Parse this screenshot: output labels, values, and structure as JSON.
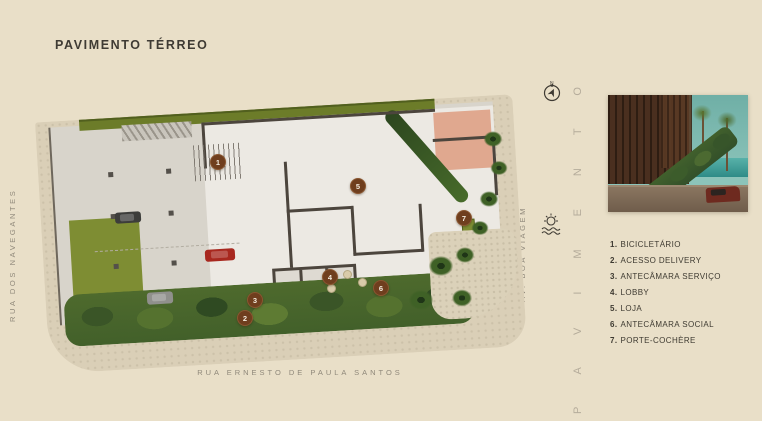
{
  "header": {
    "title": "PAVIMENTO TÉRREO"
  },
  "streets": {
    "left": "RUA DOS NAVEGANTES",
    "bottom": "RUA ERNESTO DE PAULA SANTOS",
    "right": "AV. BOA VIAGEM"
  },
  "watermark_text": "PAVIMENTO",
  "compass_label": "N",
  "legend": {
    "items": [
      {
        "num": "1.",
        "label": "BICICLETÁRIO"
      },
      {
        "num": "2.",
        "label": "ACESSO DELIVERY"
      },
      {
        "num": "3.",
        "label": "ANTECÂMARA SERVIÇO"
      },
      {
        "num": "4.",
        "label": "LOBBY"
      },
      {
        "num": "5.",
        "label": "LOJA"
      },
      {
        "num": "6.",
        "label": "ANTECÂMARA SOCIAL"
      },
      {
        "num": "7.",
        "label": "PORTE-COCHÈRE"
      }
    ]
  },
  "plan": {
    "markers": [
      {
        "num": "1",
        "x": 218,
        "y": 162
      },
      {
        "num": "5",
        "x": 358,
        "y": 186
      },
      {
        "num": "7",
        "x": 464,
        "y": 218
      },
      {
        "num": "4",
        "x": 330,
        "y": 277
      },
      {
        "num": "6",
        "x": 381,
        "y": 288
      },
      {
        "num": "3",
        "x": 255,
        "y": 300
      },
      {
        "num": "2",
        "x": 245,
        "y": 318
      }
    ]
  },
  "colors": {
    "background": "#E9DFC8",
    "marker": "#6F3E1E",
    "wall": "#4C453D",
    "lawn_green": "#7E8D33",
    "terrace_pink": "#E0A88F"
  }
}
